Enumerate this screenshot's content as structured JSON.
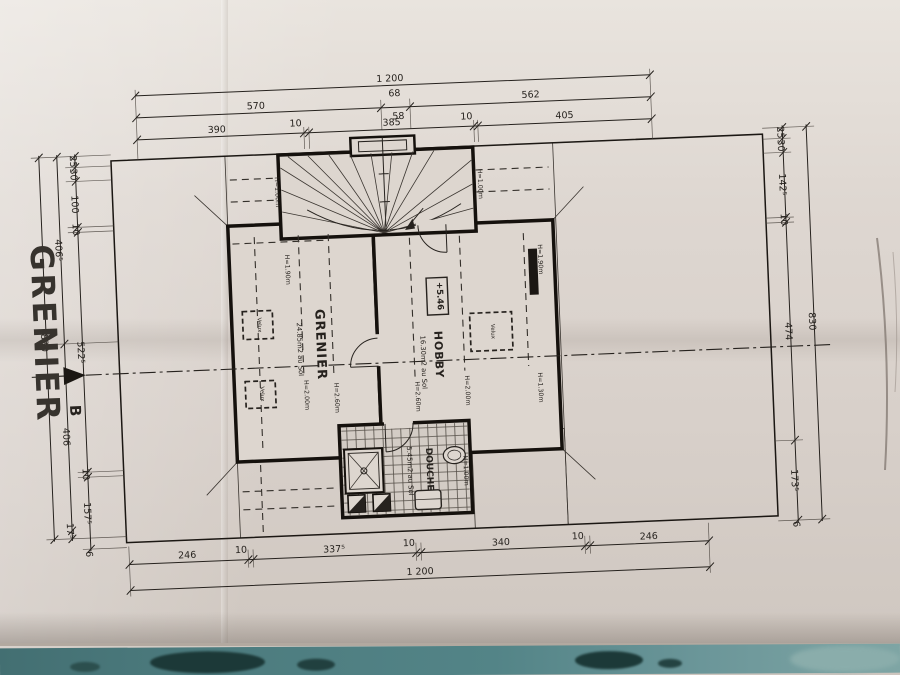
{
  "photo": {
    "table_color": "#4e7c7e",
    "paper_color": "#d9d2cb",
    "ink_color": "#26221e"
  },
  "title": {
    "text": "GRENIER"
  },
  "section": {
    "label": "B"
  },
  "plan": {
    "rooms": {
      "grenier": {
        "name": "GRENIER",
        "area": "24.85m2 au Sol",
        "h_contours": [
          "H=2.00m",
          "H=2.60m"
        ],
        "h_wall": "H=1.90m"
      },
      "hobby": {
        "name": "HOBBY",
        "area": "16.30m2 au Sol",
        "h_contours": [
          "H=2.60m",
          "H=2.00m",
          "H=1.30m"
        ],
        "h_wall": "H=1.90m",
        "elevation": "+5.46"
      },
      "douche": {
        "name": "DOUCHE",
        "area": "5.45m2 au Sol",
        "h_contour": "H=1.00m"
      },
      "stairs": {
        "h_left": "H=1.00m",
        "h_right": "H=1.00m"
      }
    },
    "velux_label": "Velux"
  },
  "dims": {
    "top": {
      "overall": "1 200",
      "row2": [
        "570",
        "68",
        "58",
        "562"
      ],
      "row3": [
        "390",
        "10",
        "385",
        "10",
        "405"
      ]
    },
    "bottom": {
      "row1": [
        "246",
        "10",
        "337⁵",
        "10",
        "340",
        "10",
        "246"
      ],
      "overall": "1 200"
    },
    "left": {
      "inner": [
        "25",
        "30",
        "100",
        "10",
        "522⁵",
        "10",
        "157⁵",
        "6"
      ],
      "middle": [
        "406⁵",
        "406",
        "17⁵"
      ],
      "outer": "830"
    },
    "right": {
      "inner": [
        "25",
        "30",
        "142⁵",
        "10",
        "474",
        "173⁵",
        "6"
      ],
      "outer": "830"
    }
  }
}
